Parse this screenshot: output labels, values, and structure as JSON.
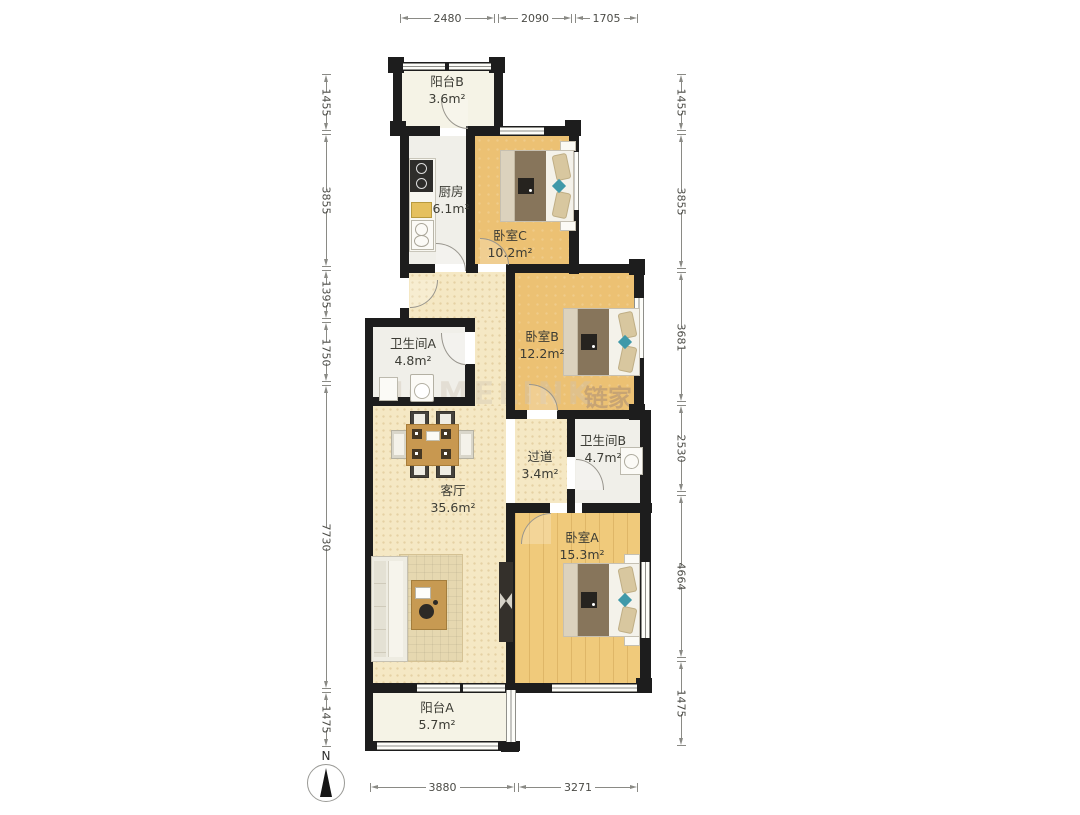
{
  "rooms": [
    {
      "name": "阳台B",
      "area": "3.6m²"
    },
    {
      "name": "厨房",
      "area": "6.1m²"
    },
    {
      "name": "卧室C",
      "area": "10.2m²"
    },
    {
      "name": "卫生间A",
      "area": "4.8m²"
    },
    {
      "name": "卧室B",
      "area": "12.2m²"
    },
    {
      "name": "过道",
      "area": "3.4m²"
    },
    {
      "name": "卫生间B",
      "area": "4.7m²"
    },
    {
      "name": "客厅",
      "area": "35.6m²"
    },
    {
      "name": "卧室A",
      "area": "15.3m²"
    },
    {
      "name": "阳台A",
      "area": "5.7m²"
    }
  ],
  "dimensions_mm": {
    "top": [
      "2480",
      "2090",
      "1705"
    ],
    "left": [
      "1455",
      "3855",
      "1395",
      "1750",
      "7730",
      "1475"
    ],
    "right": [
      "1455",
      "3855",
      "3681",
      "2530",
      "4664",
      "1475"
    ],
    "bottom": [
      "3880",
      "3271"
    ]
  },
  "compass": {
    "label": "N"
  },
  "watermark": {
    "latin": "HOMELINK",
    "cn": "链家",
    "suffix": "com"
  },
  "colors": {
    "wall": "#1d1d1d",
    "wood_floor": "#ecc173",
    "pale_floor": "#f5e8c4",
    "tile_floor": "#f0efe9",
    "balcony_floor": "#f5f3e6",
    "accent_teal": "#3f99a9",
    "dim_text": "#4c4c47"
  }
}
